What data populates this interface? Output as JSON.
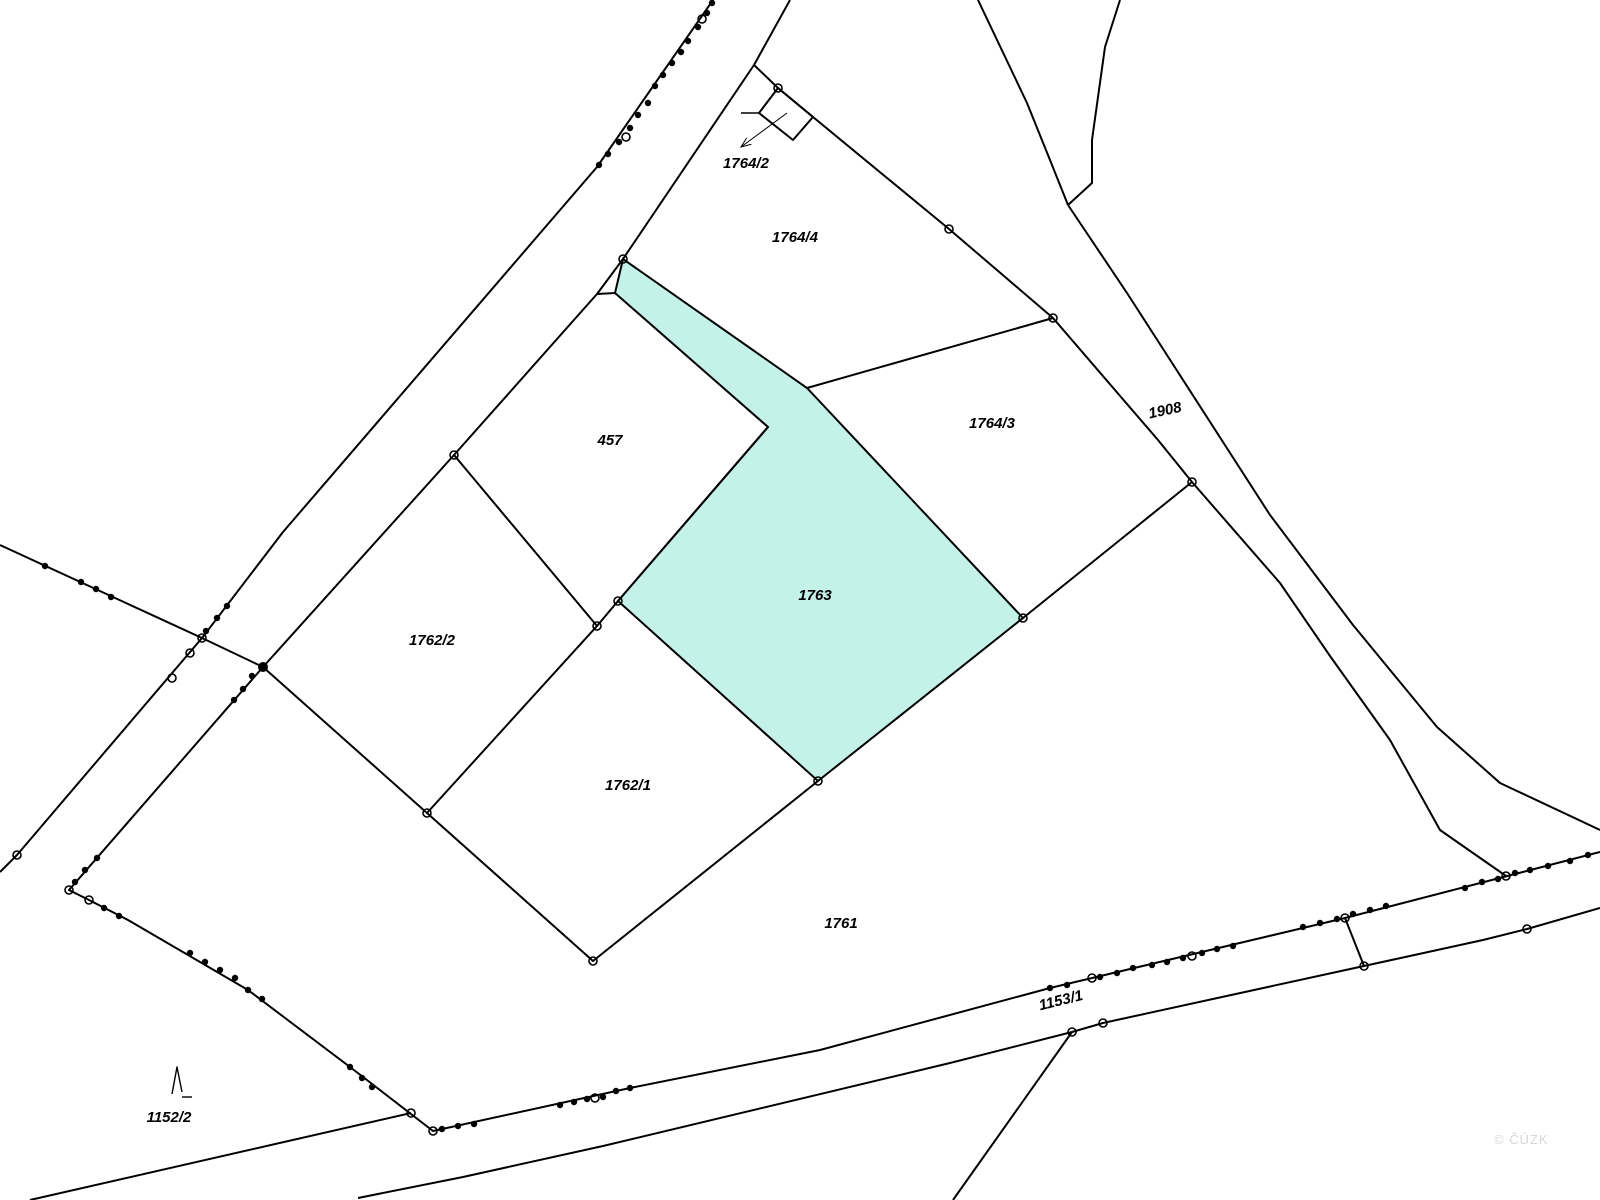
{
  "map": {
    "background": "#ffffff",
    "line_color": "#000000",
    "highlight_fill": "#c4f2e9",
    "highlight_label_color": "#3a7a72",
    "watermark": {
      "text": "© ČÚZK",
      "x": 1494,
      "y": 1132,
      "color": "#d7d7d7"
    },
    "labels": [
      {
        "id": "1764/2",
        "text": "1764/2",
        "x": 746,
        "y": 168,
        "rotate": 0,
        "color": "#000000"
      },
      {
        "id": "1764/4",
        "text": "1764/4",
        "x": 795,
        "y": 242,
        "rotate": 0,
        "color": "#000000"
      },
      {
        "id": "1764/3",
        "text": "1764/3",
        "x": 992,
        "y": 428,
        "rotate": 0,
        "color": "#000000"
      },
      {
        "id": "1908",
        "text": "1908",
        "x": 1166,
        "y": 415,
        "rotate": -12,
        "color": "#000000"
      },
      {
        "id": "457",
        "text": "457",
        "x": 610,
        "y": 445,
        "rotate": 0,
        "color": "#000000"
      },
      {
        "id": "1763",
        "text": "1763",
        "x": 815,
        "y": 600,
        "rotate": 0,
        "color": "#3a7a72"
      },
      {
        "id": "1762/2",
        "text": "1762/2",
        "x": 432,
        "y": 645,
        "rotate": 0,
        "color": "#000000"
      },
      {
        "id": "1762/1",
        "text": "1762/1",
        "x": 628,
        "y": 790,
        "rotate": 0,
        "color": "#000000"
      },
      {
        "id": "1761",
        "text": "1761",
        "x": 841,
        "y": 928,
        "rotate": 0,
        "color": "#000000"
      },
      {
        "id": "1153/1",
        "text": "1153/1",
        "x": 1062,
        "y": 1005,
        "rotate": -14,
        "color": "#000000"
      },
      {
        "id": "1152/2",
        "text": "1152/2",
        "x": 169,
        "y": 1122,
        "rotate": 0,
        "color": "#000000"
      }
    ],
    "highlight_parcel": {
      "id": "1763",
      "points": [
        [
          623,
          259
        ],
        [
          807,
          388
        ],
        [
          1023,
          618
        ],
        [
          818,
          781
        ],
        [
          618,
          601
        ],
        [
          768,
          427
        ],
        [
          615,
          293
        ]
      ]
    },
    "polylines": [
      {
        "name": "east-road-boundary",
        "points": [
          [
            790,
            0
          ],
          [
            754,
            65
          ],
          [
            623,
            259
          ],
          [
            597,
            294
          ],
          [
            454,
            455
          ],
          [
            263,
            667
          ],
          [
            69,
            890
          ],
          [
            89,
            900
          ],
          [
            128,
            920
          ],
          [
            248,
            990
          ],
          [
            350,
            1067
          ],
          [
            433,
            1131
          ],
          [
            630,
            1088
          ],
          [
            820,
            1050
          ],
          [
            1050,
            988
          ],
          [
            1345,
            918
          ],
          [
            1600,
            852
          ]
        ]
      },
      {
        "name": "west-road-boundary",
        "points": [
          [
            713,
            0
          ],
          [
            597,
            167
          ],
          [
            283,
            532
          ],
          [
            202,
            638
          ],
          [
            17,
            855
          ],
          [
            0,
            872
          ]
        ]
      },
      {
        "name": "left-diagonal-boundary",
        "points": [
          [
            0,
            545
          ],
          [
            202,
            638
          ],
          [
            263,
            667
          ]
        ]
      },
      {
        "name": "parcel-1762-sw-chain",
        "points": [
          [
            263,
            667
          ],
          [
            427,
            813
          ],
          [
            593,
            961
          ],
          [
            818,
            781
          ]
        ]
      },
      {
        "name": "parcel-457-1762-ne-chain",
        "points": [
          [
            454,
            455
          ],
          [
            597,
            626
          ],
          [
            618,
            601
          ],
          [
            768,
            427
          ]
        ]
      },
      {
        "name": "parcel-1762-2-se-edge",
        "points": [
          [
            597,
            626
          ],
          [
            427,
            813
          ]
        ]
      },
      {
        "name": "parcel-457-north-notch",
        "points": [
          [
            597,
            294
          ],
          [
            615,
            293
          ]
        ]
      },
      {
        "name": "block-1764-nw-boundary",
        "points": [
          [
            754,
            65
          ],
          [
            778,
            88
          ],
          [
            813,
            117
          ],
          [
            949,
            229
          ]
        ]
      },
      {
        "name": "parcel-1764-2-square",
        "points": [
          [
            778,
            88
          ],
          [
            813,
            117
          ],
          [
            793,
            140
          ],
          [
            759,
            113
          ],
          [
            778,
            88
          ]
        ]
      },
      {
        "name": "parcel-1764-2-tick",
        "points": [
          [
            741,
            113
          ],
          [
            759,
            113
          ]
        ]
      },
      {
        "name": "top-wedge-left-line",
        "points": [
          [
            978,
            0
          ],
          [
            1027,
            103
          ],
          [
            1050,
            160
          ],
          [
            1068,
            205
          ]
        ]
      },
      {
        "name": "top-wedge-right-line",
        "points": [
          [
            1120,
            0
          ],
          [
            1105,
            47
          ],
          [
            1092,
            140
          ],
          [
            1092,
            183
          ],
          [
            1068,
            205
          ]
        ]
      },
      {
        "name": "road-1908-ne-boundary",
        "points": [
          [
            1068,
            205
          ],
          [
            1127,
            293
          ],
          [
            1270,
            515
          ],
          [
            1353,
            625
          ],
          [
            1437,
            727
          ],
          [
            1500,
            783
          ],
          [
            1600,
            830
          ]
        ]
      },
      {
        "name": "road-1908-sw-boundary",
        "points": [
          [
            949,
            229
          ],
          [
            1053,
            318
          ],
          [
            1158,
            440
          ],
          [
            1192,
            482
          ],
          [
            1280,
            583
          ],
          [
            1330,
            656
          ],
          [
            1390,
            740
          ],
          [
            1440,
            830
          ],
          [
            1506,
            876
          ]
        ]
      },
      {
        "name": "parcel-1764-4-se-edge",
        "points": [
          [
            1053,
            318
          ],
          [
            807,
            388
          ]
        ]
      },
      {
        "name": "parcel-1764-3-se-edge",
        "points": [
          [
            1023,
            618
          ],
          [
            1192,
            482
          ]
        ]
      },
      {
        "name": "road-1153-south-boundary",
        "points": [
          [
            358,
            1198
          ],
          [
            463,
            1177
          ],
          [
            603,
            1146
          ],
          [
            950,
            1063
          ],
          [
            1072,
            1032
          ],
          [
            1103,
            1023
          ],
          [
            1364,
            966
          ],
          [
            1483,
            940
          ],
          [
            1527,
            929
          ],
          [
            1600,
            908
          ]
        ]
      },
      {
        "name": "bottom-branch-line",
        "points": [
          [
            1072,
            1032
          ],
          [
            987,
            1152
          ],
          [
            953,
            1200
          ]
        ]
      },
      {
        "name": "road-1153-connector",
        "points": [
          [
            1345,
            918
          ],
          [
            1364,
            966
          ]
        ]
      },
      {
        "name": "bottom-left-boundary",
        "points": [
          [
            30,
            1200
          ],
          [
            411,
            1113
          ]
        ]
      },
      {
        "name": "tree-symbol-spike",
        "points": [
          [
            172,
            1094
          ],
          [
            177,
            1067
          ],
          [
            182,
            1092
          ]
        ]
      },
      {
        "name": "tree-symbol-foot",
        "points": [
          [
            182,
            1097
          ],
          [
            192,
            1097
          ]
        ]
      }
    ],
    "leader_arrow": {
      "from": [
        787,
        113
      ],
      "to": [
        741,
        147
      ]
    },
    "vertex_circles": [
      [
        623,
        259
      ],
      [
        778,
        88
      ],
      [
        949,
        229
      ],
      [
        1053,
        318
      ],
      [
        1192,
        482
      ],
      [
        1023,
        618
      ],
      [
        818,
        781
      ],
      [
        618,
        601
      ],
      [
        597,
        626
      ],
      [
        454,
        455
      ],
      [
        427,
        813
      ],
      [
        593,
        961
      ],
      [
        202,
        638
      ],
      [
        190,
        653
      ],
      [
        172,
        678
      ],
      [
        17,
        855
      ],
      [
        69,
        890
      ],
      [
        89,
        900
      ],
      [
        411,
        1113
      ],
      [
        433,
        1131
      ],
      [
        1072,
        1032
      ],
      [
        1103,
        1023
      ],
      [
        1364,
        966
      ],
      [
        1527,
        929
      ],
      [
        1345,
        918
      ],
      [
        1506,
        876
      ],
      [
        595,
        1098
      ],
      [
        1092,
        978
      ],
      [
        1192,
        956
      ],
      [
        626,
        137
      ],
      [
        702,
        19
      ]
    ],
    "survey_dots": [
      [
        712,
        3
      ],
      [
        707,
        13
      ],
      [
        698,
        27
      ],
      [
        688,
        41
      ],
      [
        681,
        52
      ],
      [
        672,
        63
      ],
      [
        663,
        75
      ],
      [
        655,
        86
      ],
      [
        648,
        103
      ],
      [
        638,
        115
      ],
      [
        630,
        128
      ],
      [
        619,
        142
      ],
      [
        608,
        154
      ],
      [
        599,
        165
      ],
      [
        227,
        606
      ],
      [
        217,
        618
      ],
      [
        206,
        631
      ],
      [
        45,
        566
      ],
      [
        81,
        582
      ],
      [
        96,
        589
      ],
      [
        111,
        597
      ],
      [
        252,
        676
      ],
      [
        243,
        689
      ],
      [
        234,
        700
      ],
      [
        97,
        858
      ],
      [
        85,
        870
      ],
      [
        75,
        882
      ],
      [
        104,
        908
      ],
      [
        119,
        916
      ],
      [
        190,
        953
      ],
      [
        205,
        962
      ],
      [
        220,
        970
      ],
      [
        235,
        978
      ],
      [
        248,
        990
      ],
      [
        262,
        999
      ],
      [
        350,
        1067
      ],
      [
        362,
        1078
      ],
      [
        372,
        1087
      ],
      [
        442,
        1129
      ],
      [
        458,
        1126
      ],
      [
        474,
        1124
      ],
      [
        560,
        1105
      ],
      [
        574,
        1102
      ],
      [
        587,
        1099
      ],
      [
        603,
        1097
      ],
      [
        616,
        1091
      ],
      [
        630,
        1088
      ],
      [
        1050,
        988
      ],
      [
        1067,
        985
      ],
      [
        1100,
        977
      ],
      [
        1117,
        973
      ],
      [
        1133,
        968
      ],
      [
        1152,
        965
      ],
      [
        1167,
        962
      ],
      [
        1183,
        958
      ],
      [
        1202,
        953
      ],
      [
        1217,
        949
      ],
      [
        1233,
        946
      ],
      [
        1303,
        927
      ],
      [
        1320,
        923
      ],
      [
        1337,
        919
      ],
      [
        1353,
        914
      ],
      [
        1370,
        910
      ],
      [
        1386,
        906
      ],
      [
        1465,
        888
      ],
      [
        1482,
        882
      ],
      [
        1498,
        879
      ],
      [
        1515,
        873
      ],
      [
        1530,
        870
      ],
      [
        1548,
        866
      ],
      [
        1570,
        861
      ],
      [
        1588,
        855
      ]
    ],
    "junction_dots": [
      [
        263,
        667
      ]
    ]
  }
}
